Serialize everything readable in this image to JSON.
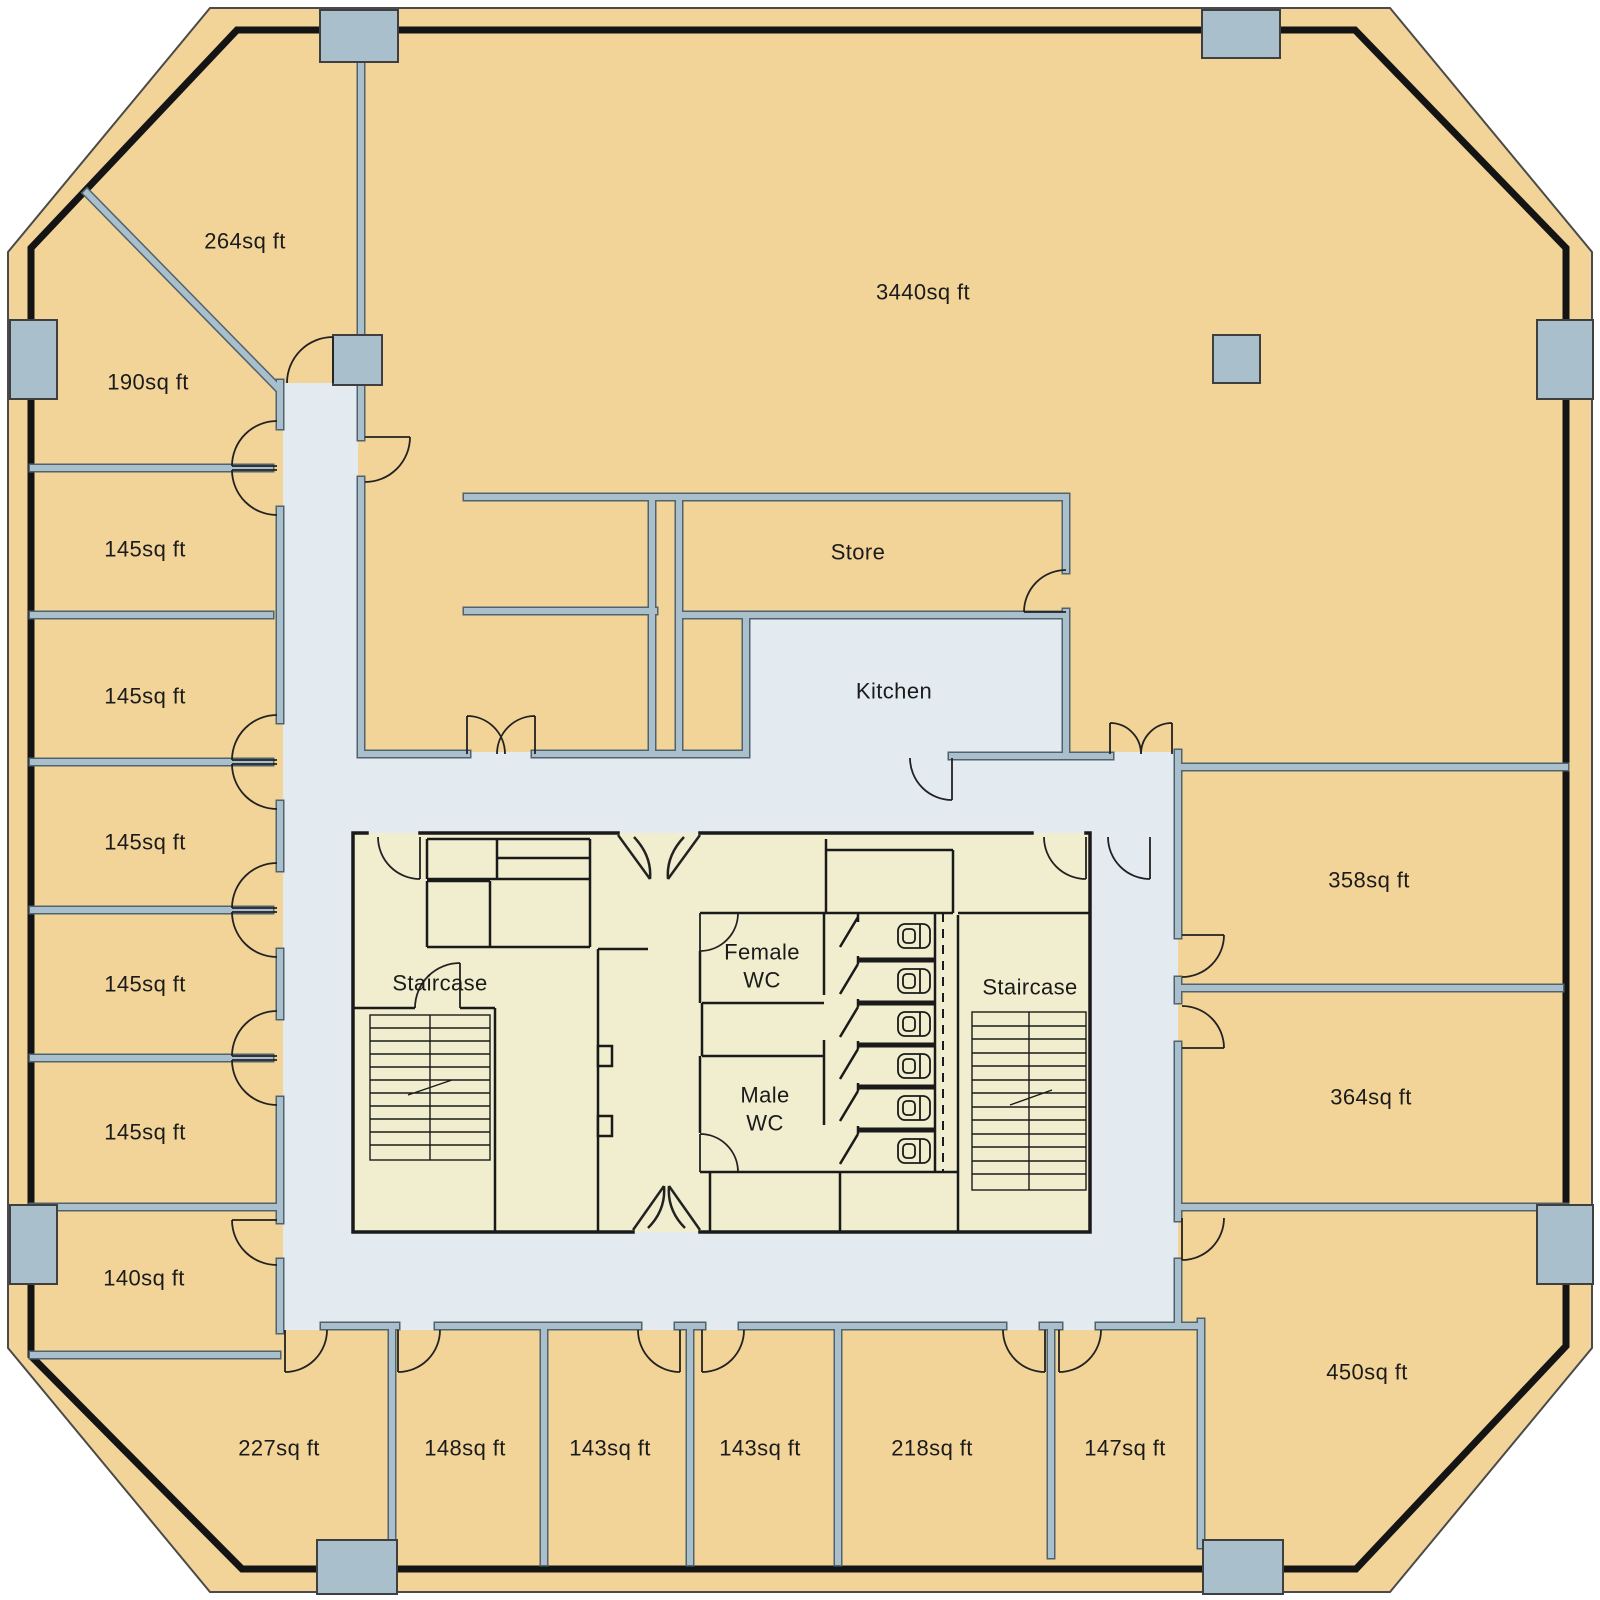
{
  "title": "Office building floor plan",
  "rooms": {
    "open_plan": "3440sq ft",
    "store": "Store",
    "kitchen": "Kitchen",
    "r264": "264sq ft",
    "r190": "190sq ft",
    "r145": "145sq ft",
    "r140": "140sq ft",
    "r227": "227sq ft",
    "r148": "148sq ft",
    "r143": "143sq ft",
    "r218": "218sq ft",
    "r147": "147sq ft",
    "r450": "450sq ft",
    "r364": "364sq ft",
    "r358": "358sq ft"
  },
  "core": {
    "staircase": "Staircase",
    "female_wc": "Female\nWC",
    "male_wc": "Male\nWC"
  },
  "colors": {
    "room_fill": "#F2D498",
    "corridor_fill": "#E3EAF0",
    "core_fill": "#F0EECE",
    "wall_gray": "#A9BFCC",
    "wall_edge": "#4F626E",
    "outline_black": "#141414",
    "text": "#1B1B1B"
  }
}
